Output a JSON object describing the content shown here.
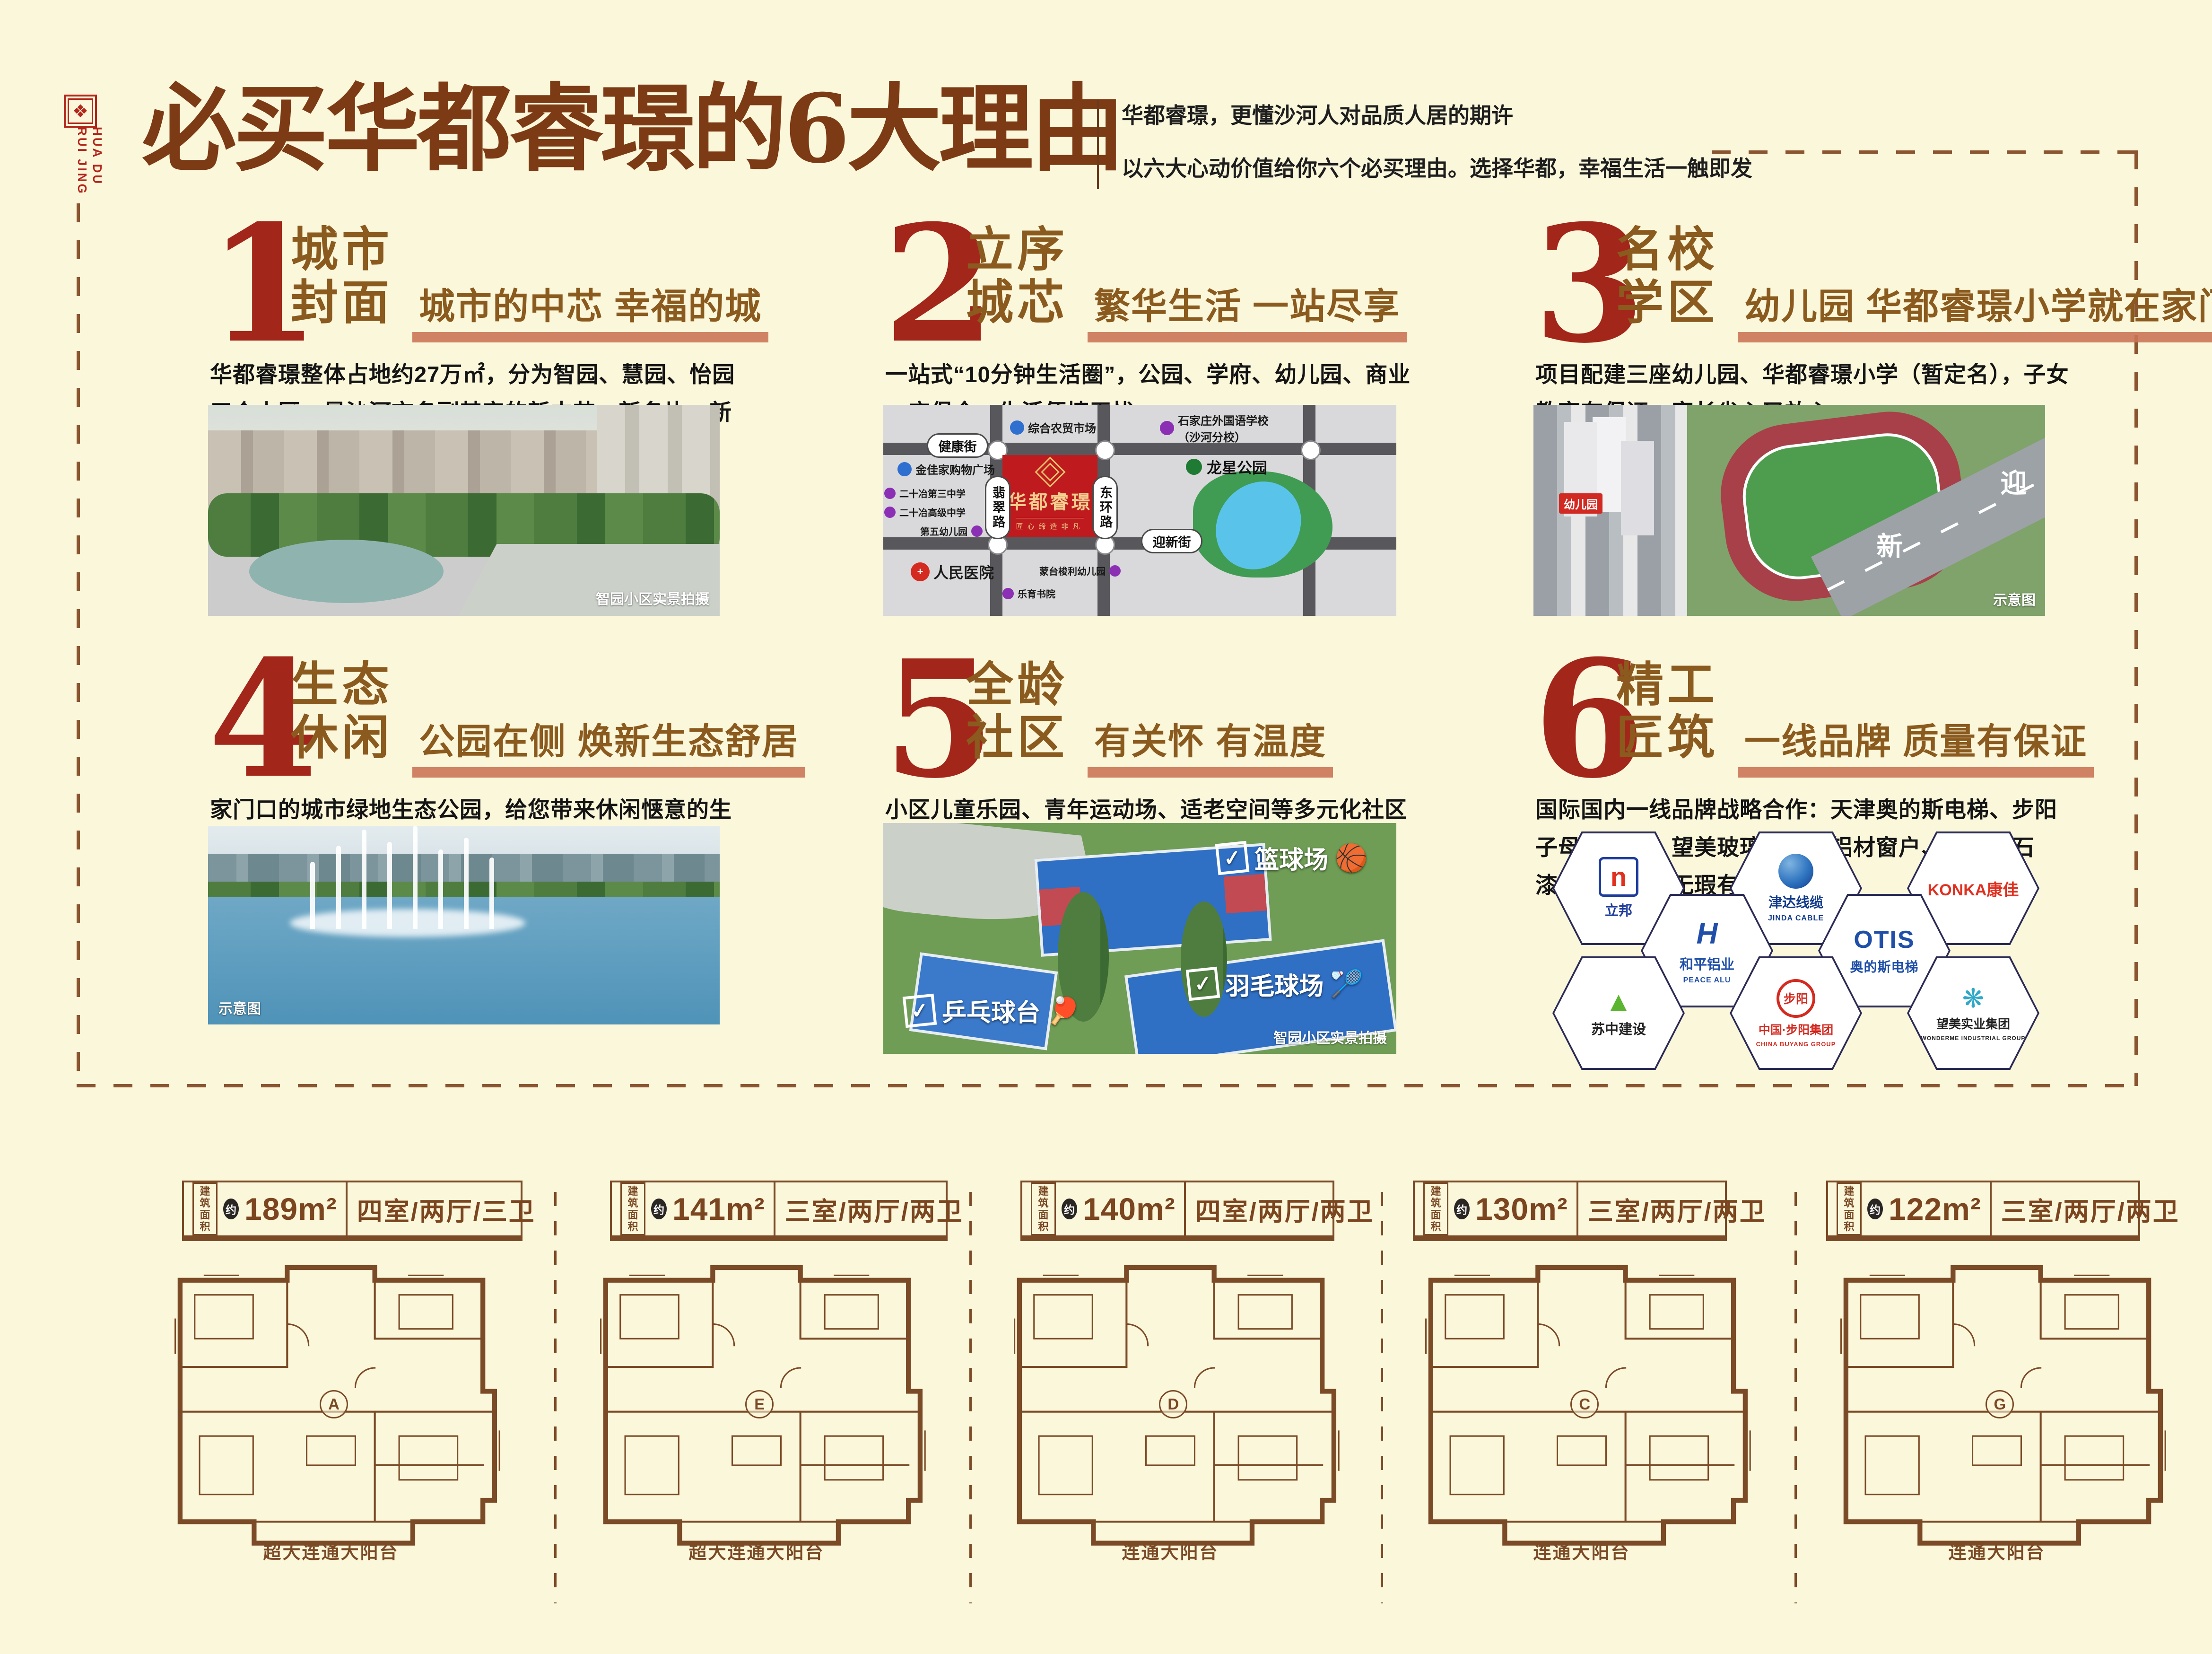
{
  "poster": {
    "background": "#FBF7DB",
    "accent_red": "#A3261A",
    "accent_brown": "#8A5A1E",
    "underline_color": "#CB7656",
    "title_color": "#7C3A15"
  },
  "logo": {
    "seal_glyph": "❖",
    "line1": "HUA DU",
    "line2": "RUI JING"
  },
  "header": {
    "title": "必买华都睿璟的6大理由",
    "tagline1": "华都睿璟，更懂沙河人对品质人居的期许",
    "tagline2": "以六大心动价值给你六个必买理由。选择华都，幸福生活一触即发"
  },
  "reasons": [
    {
      "num": "1",
      "title1": "城市",
      "title2": "封面",
      "subtitle": "城市的中芯 幸福的城",
      "body": "华都睿璟整体占地约27万㎡，分为智园、慧园、怡园三个小区，是沙河市名副其实的新中芯、新名片、新封面。"
    },
    {
      "num": "2",
      "title1": "立序",
      "title2": "城芯",
      "subtitle": "繁华生活 一站尽享",
      "body": "一站式“10分钟生活圈”，公园、学府、幼儿园、商业一应俱全，生活便捷无忧。"
    },
    {
      "num": "3",
      "title1": "名校",
      "title2": "学区",
      "subtitle": "幼儿园 华都睿璟小学就在家门口",
      "body": "项目配建三座幼儿园、华都睿璟小学（暂定名），子女教育有保证，家长省心又放心。"
    },
    {
      "num": "4",
      "title1": "生态",
      "title2": "休闲",
      "subtitle": "公园在侧 焕新生态舒居",
      "body": "家门口的城市绿地生态公园，给您带来休闲惬意的生活环境。"
    },
    {
      "num": "5",
      "title1": "全龄",
      "title2": "社区",
      "subtitle": "有关怀 有温度",
      "body": "小区儿童乐园、青年运动场、适老空间等多元化社区配套，闲暇之余，享受生活的美好。"
    },
    {
      "num": "6",
      "title1": "精工",
      "title2": "匠筑",
      "subtitle": "一线品牌 质量有保证",
      "body": "国际国内一线品牌战略合作：天津奥的斯电梯、步阳子母入户门、望美玻璃、和平铝材窗户、立邦真石漆，房子质量无瑕有保证。"
    }
  ],
  "photos": {
    "p1_caption": "智园小区实景拍摄",
    "p3_caption": "示意图",
    "p3_road_char1": "迎",
    "p3_road_char2": "新",
    "p3_badge": "幼儿园",
    "p4_caption": "示意图",
    "p5_caption": "智园小区实景拍摄",
    "p5_tag_check": "✓",
    "p5_tag1": "篮球场",
    "p5_tag2": "羽毛球场",
    "p5_tag3": "乒乓球台",
    "p5_ball1": "🏀",
    "p5_ball2": "🏸",
    "p5_ball3": "🏓"
  },
  "map": {
    "streets": {
      "h1": "健康街",
      "h2": "迎新街",
      "v1": "翡翠路",
      "v2": "东环路"
    },
    "project": {
      "name": "华都睿璟",
      "slogan": "匠心缔造非凡"
    },
    "park": "龙星公园",
    "pois": [
      {
        "label": "综合农贸市场",
        "color": "#2E6FD0"
      },
      {
        "label": "石家庄外国语学校",
        "label2": "（沙河分校）",
        "color": "#8B2FB4"
      },
      {
        "label": "金佳家购物广场",
        "color": "#2E6FD0"
      },
      {
        "label": "二十冶第三中学",
        "color": "#8B2FB4"
      },
      {
        "label": "二十冶高级中学",
        "color": "#8B2FB4"
      },
      {
        "label": "第五幼儿园",
        "color": "#8B2FB4"
      },
      {
        "label": "人民医院",
        "color": "#D42A20",
        "glyph": "+"
      },
      {
        "label": "蒙台梭利幼儿园",
        "color": "#8B2FB4"
      },
      {
        "label": "乐育书院",
        "color": "#8B2FB4"
      }
    ]
  },
  "brands": [
    {
      "name": "立邦",
      "glyph": "n"
    },
    {
      "name": "津达线缆",
      "sub": "JINDA CABLE"
    },
    {
      "name": "KONKA康佳"
    },
    {
      "name": "和平铝业",
      "sub": "PEACE ALU",
      "glyph": "H"
    },
    {
      "name": "OTIS",
      "sub": "奥的斯电梯"
    },
    {
      "name": "苏中建设",
      "glyph": "▲"
    },
    {
      "name": "中国·步阳集团",
      "sub": "CHINA BUYANG GROUP",
      "glyph": "步阳"
    },
    {
      "name": "望美实业集团",
      "sub": "WONDERME INDUSTRIAL GROUP",
      "glyph": "❋"
    }
  ],
  "floorplans": {
    "area_prefix1": "建筑",
    "area_prefix2": "面积",
    "approx": "约",
    "items": [
      {
        "area": "189m²",
        "layout": "四室/两厅/三卫",
        "letter": "A",
        "balcony": "超大连通大阳台"
      },
      {
        "area": "141m²",
        "layout": "三室/两厅/两卫",
        "letter": "E",
        "balcony": "超大连通大阳台"
      },
      {
        "area": "140m²",
        "layout": "四室/两厅/两卫",
        "letter": "D",
        "balcony": "连通大阳台"
      },
      {
        "area": "130m²",
        "layout": "三室/两厅/两卫",
        "letter": "C",
        "balcony": "连通大阳台"
      },
      {
        "area": "122m²",
        "layout": "三室/两厅/两卫",
        "letter": "G",
        "balcony": "连通大阳台"
      }
    ]
  }
}
